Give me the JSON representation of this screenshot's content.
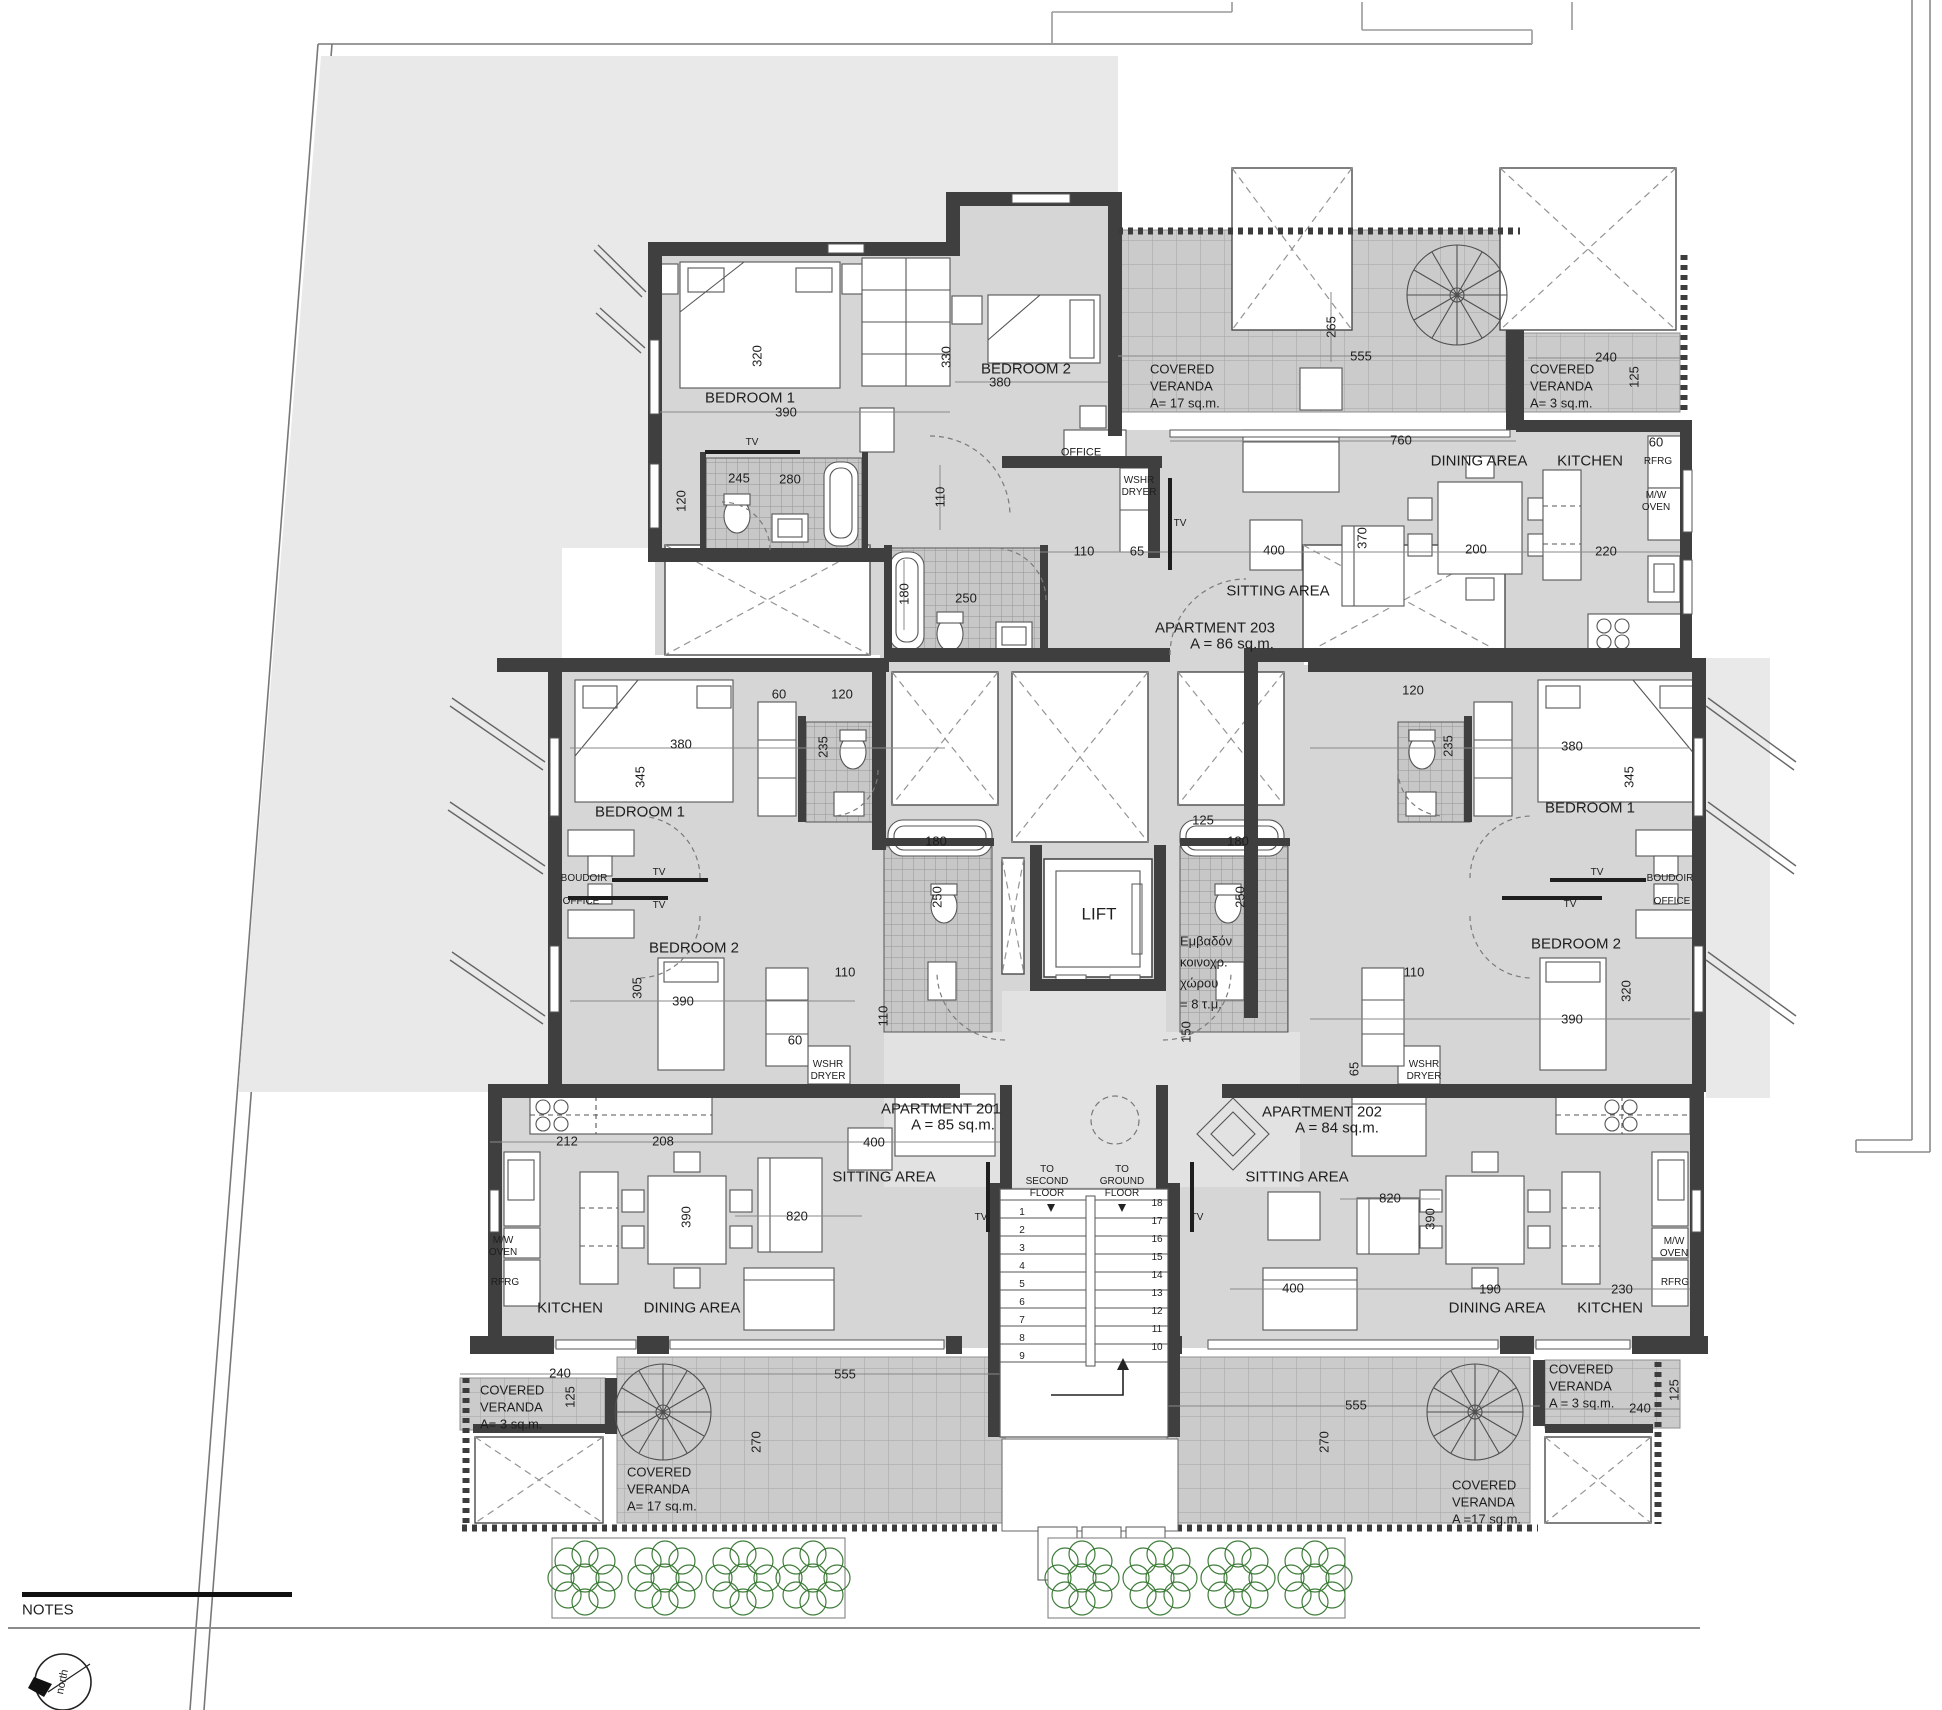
{
  "meta": {
    "drawing_type": "architectural floor plan",
    "notes_label": "NOTES",
    "north_label": "north"
  },
  "colors": {
    "wall": "#3f3f3f",
    "room_fill": "#d6d6d6",
    "deck_fill": "#e9e9e9",
    "veranda_fill": "#cbcbcb",
    "tree_green": "#3f7d3a",
    "line": "#555555"
  },
  "apartments": [
    {
      "name": "APARTMENT 201",
      "area": "A = 85 sq.m.",
      "rooms": [
        "BEDROOM 1",
        "BEDROOM 2",
        "SITTING AREA",
        "DINING AREA",
        "KITCHEN"
      ]
    },
    {
      "name": "APARTMENT 202",
      "area": "A = 84 sq.m.",
      "rooms": [
        "BEDROOM 1",
        "BEDROOM 2",
        "SITTING AREA",
        "DINING AREA",
        "KITCHEN"
      ]
    },
    {
      "name": "APARTMENT 203",
      "area": "A = 86 sq.m.",
      "rooms": [
        "BEDROOM 1",
        "BEDROOM 2",
        "SITTING AREA",
        "DINING AREA",
        "KITCHEN"
      ]
    }
  ],
  "common_area_note": [
    "Εμβαδόν",
    "κοινοχρ.",
    "χώρου",
    "= 8 τ.μ."
  ],
  "stairs": {
    "left_numbers": [
      1,
      2,
      3,
      4,
      5,
      6,
      7,
      8,
      9
    ],
    "right_numbers": [
      18,
      17,
      16,
      15,
      14,
      13,
      12,
      11,
      10
    ],
    "left_x": 1022,
    "left_y0": 1213,
    "right_x": 1157,
    "right_y0": 1204,
    "step": 18
  },
  "landscape": {
    "tree_rows": [
      {
        "y": 1578,
        "xs": [
          585,
          665,
          743,
          813
        ]
      },
      {
        "y": 1578,
        "xs": [
          1082,
          1160,
          1238,
          1315
        ]
      }
    ]
  },
  "labels": [
    {
      "t": "BEDROOM 1",
      "x": 750,
      "y": 398,
      "s": 15
    },
    {
      "t": "390",
      "x": 786,
      "y": 412
    },
    {
      "t": "320",
      "x": 757,
      "y": 356,
      "r": -90
    },
    {
      "t": "BEDROOM 2",
      "x": 1026,
      "y": 369,
      "s": 15
    },
    {
      "t": "380",
      "x": 1000,
      "y": 382
    },
    {
      "t": "330",
      "x": 946,
      "y": 357,
      "r": -90
    },
    {
      "t": "OFFICE",
      "x": 1081,
      "y": 453,
      "s": 11
    },
    {
      "t": "TV",
      "x": 752,
      "y": 443,
      "s": 10
    },
    {
      "t": "245",
      "x": 739,
      "y": 478
    },
    {
      "t": "120",
      "x": 681,
      "y": 501,
      "r": -90
    },
    {
      "t": "280",
      "x": 790,
      "y": 479
    },
    {
      "t": "110",
      "x": 940,
      "y": 497,
      "r": -90
    },
    {
      "t": "COVERED",
      "x": 1150,
      "y": 369,
      "a": "l"
    },
    {
      "t": "VERANDA",
      "x": 1150,
      "y": 386,
      "a": "l"
    },
    {
      "t": "A= 17 sq.m.",
      "x": 1150,
      "y": 403,
      "a": "l"
    },
    {
      "t": "265",
      "x": 1331,
      "y": 327,
      "r": -90
    },
    {
      "t": "555",
      "x": 1361,
      "y": 356
    },
    {
      "t": "COVERED",
      "x": 1530,
      "y": 369,
      "a": "l"
    },
    {
      "t": "VERANDA",
      "x": 1530,
      "y": 386,
      "a": "l"
    },
    {
      "t": "A= 3 sq.m.",
      "x": 1530,
      "y": 403,
      "a": "l"
    },
    {
      "t": "240",
      "x": 1606,
      "y": 357
    },
    {
      "t": "125",
      "x": 1634,
      "y": 377,
      "r": -90
    },
    {
      "t": "760",
      "x": 1401,
      "y": 440
    },
    {
      "t": "DINING AREA",
      "x": 1479,
      "y": 461,
      "s": 15
    },
    {
      "t": "200",
      "x": 1476,
      "y": 549
    },
    {
      "t": "KITCHEN",
      "x": 1590,
      "y": 461,
      "s": 15
    },
    {
      "t": "60",
      "x": 1656,
      "y": 442
    },
    {
      "t": "RFRG",
      "x": 1658,
      "y": 462,
      "s": 10
    },
    {
      "t": "M/W",
      "x": 1656,
      "y": 496,
      "s": 10
    },
    {
      "t": "OVEN",
      "x": 1656,
      "y": 508,
      "s": 10
    },
    {
      "t": "220",
      "x": 1606,
      "y": 551
    },
    {
      "t": "SITTING AREA",
      "x": 1278,
      "y": 591,
      "s": 15
    },
    {
      "t": "400",
      "x": 1274,
      "y": 550
    },
    {
      "t": "370",
      "x": 1362,
      "y": 538,
      "r": -90
    },
    {
      "t": "APARTMENT 203",
      "x": 1215,
      "y": 628,
      "s": 15
    },
    {
      "t": "A = 86 sq.m.",
      "x": 1232,
      "y": 644,
      "s": 15
    },
    {
      "t": "WSHR",
      "x": 1139,
      "y": 481,
      "s": 10
    },
    {
      "t": "DRYER",
      "x": 1139,
      "y": 493,
      "s": 10
    },
    {
      "t": "110",
      "x": 1084,
      "y": 551
    },
    {
      "t": "65",
      "x": 1137,
      "y": 551
    },
    {
      "t": "TV",
      "x": 1180,
      "y": 524,
      "s": 10
    },
    {
      "t": "180",
      "x": 904,
      "y": 594,
      "r": -90
    },
    {
      "t": "250",
      "x": 966,
      "y": 598
    },
    {
      "t": "LIFT",
      "x": 1099,
      "y": 914,
      "s": 17
    },
    {
      "t": "Εμβαδόν",
      "x": 1180,
      "y": 941,
      "a": "l"
    },
    {
      "t": "κοινοχρ.",
      "x": 1180,
      "y": 962,
      "a": "l"
    },
    {
      "t": "χώρου",
      "x": 1180,
      "y": 983,
      "a": "l"
    },
    {
      "t": "= 8 τ.μ.",
      "x": 1180,
      "y": 1004,
      "a": "l"
    },
    {
      "t": "125",
      "x": 1203,
      "y": 820
    },
    {
      "t": "150",
      "x": 1186,
      "y": 1032,
      "r": -90
    },
    {
      "t": "180",
      "x": 936,
      "y": 841
    },
    {
      "t": "250",
      "x": 937,
      "y": 897,
      "r": -90
    },
    {
      "t": "180",
      "x": 1238,
      "y": 841
    },
    {
      "t": "250",
      "x": 1240,
      "y": 897,
      "r": -90
    },
    {
      "t": "BEDROOM 1",
      "x": 640,
      "y": 812,
      "s": 15
    },
    {
      "t": "380",
      "x": 681,
      "y": 744
    },
    {
      "t": "345",
      "x": 640,
      "y": 777,
      "r": -90
    },
    {
      "t": "60",
      "x": 779,
      "y": 694
    },
    {
      "t": "120",
      "x": 842,
      "y": 694
    },
    {
      "t": "235",
      "x": 823,
      "y": 747,
      "r": -90
    },
    {
      "t": "BOUDOIR",
      "x": 584,
      "y": 879,
      "s": 10
    },
    {
      "t": "OFFICE",
      "x": 581,
      "y": 902,
      "s": 10
    },
    {
      "t": "TV",
      "x": 659,
      "y": 873,
      "s": 10
    },
    {
      "t": "TV",
      "x": 659,
      "y": 906,
      "s": 10
    },
    {
      "t": "BEDROOM 2",
      "x": 694,
      "y": 948,
      "s": 15
    },
    {
      "t": "390",
      "x": 683,
      "y": 1001
    },
    {
      "t": "305",
      "x": 637,
      "y": 988,
      "r": -90
    },
    {
      "t": "60",
      "x": 795,
      "y": 1040
    },
    {
      "t": "110",
      "x": 845,
      "y": 972
    },
    {
      "t": "110",
      "x": 883,
      "y": 1016,
      "r": -90
    },
    {
      "t": "WSHR",
      "x": 828,
      "y": 1065,
      "s": 10
    },
    {
      "t": "DRYER",
      "x": 828,
      "y": 1077,
      "s": 10
    },
    {
      "t": "APARTMENT 201",
      "x": 941,
      "y": 1109,
      "s": 15
    },
    {
      "t": "A = 85 sq.m.",
      "x": 953,
      "y": 1125,
      "s": 15
    },
    {
      "t": "400",
      "x": 874,
      "y": 1142
    },
    {
      "t": "SITTING AREA",
      "x": 884,
      "y": 1177,
      "s": 15
    },
    {
      "t": "820",
      "x": 797,
      "y": 1216
    },
    {
      "t": "390",
      "x": 686,
      "y": 1217,
      "r": -90
    },
    {
      "t": "212",
      "x": 567,
      "y": 1141
    },
    {
      "t": "208",
      "x": 663,
      "y": 1141
    },
    {
      "t": "KITCHEN",
      "x": 570,
      "y": 1308,
      "s": 15
    },
    {
      "t": "DINING AREA",
      "x": 692,
      "y": 1308,
      "s": 15
    },
    {
      "t": "M/W",
      "x": 503,
      "y": 1241,
      "s": 10
    },
    {
      "t": "OVEN",
      "x": 503,
      "y": 1253,
      "s": 10
    },
    {
      "t": "RFRG",
      "x": 505,
      "y": 1283,
      "s": 10
    },
    {
      "t": "TV",
      "x": 981,
      "y": 1218,
      "s": 10
    },
    {
      "t": "BEDROOM 1",
      "x": 1590,
      "y": 808,
      "s": 15
    },
    {
      "t": "380",
      "x": 1572,
      "y": 746
    },
    {
      "t": "345",
      "x": 1629,
      "y": 777,
      "r": -90
    },
    {
      "t": "120",
      "x": 1413,
      "y": 690
    },
    {
      "t": "235",
      "x": 1448,
      "y": 746,
      "r": -90
    },
    {
      "t": "BOUDOIR",
      "x": 1670,
      "y": 879,
      "s": 10
    },
    {
      "t": "OFFICE",
      "x": 1672,
      "y": 902,
      "s": 10
    },
    {
      "t": "TV",
      "x": 1597,
      "y": 873,
      "s": 10
    },
    {
      "t": "TV",
      "x": 1570,
      "y": 905,
      "s": 10
    },
    {
      "t": "BEDROOM 2",
      "x": 1576,
      "y": 944,
      "s": 15
    },
    {
      "t": "390",
      "x": 1572,
      "y": 1019
    },
    {
      "t": "320",
      "x": 1626,
      "y": 991,
      "r": -90
    },
    {
      "t": "110",
      "x": 1414,
      "y": 972
    },
    {
      "t": "65",
      "x": 1354,
      "y": 1069,
      "r": -90
    },
    {
      "t": "WSHR",
      "x": 1424,
      "y": 1065,
      "s": 10
    },
    {
      "t": "DRYER",
      "x": 1424,
      "y": 1077,
      "s": 10
    },
    {
      "t": "APARTMENT 202",
      "x": 1322,
      "y": 1112,
      "s": 15
    },
    {
      "t": "A = 84 sq.m.",
      "x": 1337,
      "y": 1128,
      "s": 15
    },
    {
      "t": "SITTING AREA",
      "x": 1297,
      "y": 1177,
      "s": 15
    },
    {
      "t": "820",
      "x": 1390,
      "y": 1198
    },
    {
      "t": "390",
      "x": 1430,
      "y": 1219,
      "r": -90
    },
    {
      "t": "400",
      "x": 1293,
      "y": 1288
    },
    {
      "t": "190",
      "x": 1490,
      "y": 1289
    },
    {
      "t": "230",
      "x": 1622,
      "y": 1289
    },
    {
      "t": "DINING AREA",
      "x": 1497,
      "y": 1308,
      "s": 15
    },
    {
      "t": "KITCHEN",
      "x": 1610,
      "y": 1308,
      "s": 15
    },
    {
      "t": "M/W",
      "x": 1674,
      "y": 1242,
      "s": 10
    },
    {
      "t": "OVEN",
      "x": 1674,
      "y": 1254,
      "s": 10
    },
    {
      "t": "RFRG",
      "x": 1675,
      "y": 1283,
      "s": 10
    },
    {
      "t": "TV",
      "x": 1197,
      "y": 1218,
      "s": 10
    },
    {
      "t": "240",
      "x": 560,
      "y": 1373
    },
    {
      "t": "125",
      "x": 570,
      "y": 1397,
      "r": -90
    },
    {
      "t": "COVERED",
      "x": 480,
      "y": 1390,
      "a": "l"
    },
    {
      "t": "VERANDA",
      "x": 480,
      "y": 1407,
      "a": "l"
    },
    {
      "t": "A= 3 sq.m.",
      "x": 480,
      "y": 1424,
      "a": "l"
    },
    {
      "t": "555",
      "x": 845,
      "y": 1374
    },
    {
      "t": "270",
      "x": 756,
      "y": 1442,
      "r": -90
    },
    {
      "t": "COVERED",
      "x": 627,
      "y": 1472,
      "a": "l"
    },
    {
      "t": "VERANDA",
      "x": 627,
      "y": 1489,
      "a": "l"
    },
    {
      "t": "A= 17 sq.m.",
      "x": 627,
      "y": 1506,
      "a": "l"
    },
    {
      "t": "TO",
      "x": 1047,
      "y": 1170,
      "s": 10
    },
    {
      "t": "SECOND",
      "x": 1047,
      "y": 1182,
      "s": 10
    },
    {
      "t": "FLOOR",
      "x": 1047,
      "y": 1194,
      "s": 10
    },
    {
      "t": "TO",
      "x": 1122,
      "y": 1170,
      "s": 10
    },
    {
      "t": "GROUND",
      "x": 1122,
      "y": 1182,
      "s": 10
    },
    {
      "t": "FLOOR",
      "x": 1122,
      "y": 1194,
      "s": 10
    },
    {
      "t": "555",
      "x": 1356,
      "y": 1405
    },
    {
      "t": "270",
      "x": 1324,
      "y": 1442,
      "r": -90
    },
    {
      "t": "COVERED",
      "x": 1452,
      "y": 1485,
      "a": "l"
    },
    {
      "t": "VERANDA",
      "x": 1452,
      "y": 1502,
      "a": "l"
    },
    {
      "t": "A =17 sq.m.",
      "x": 1452,
      "y": 1519,
      "a": "l"
    },
    {
      "t": "COVERED",
      "x": 1549,
      "y": 1369,
      "a": "l"
    },
    {
      "t": "VERANDA",
      "x": 1549,
      "y": 1386,
      "a": "l"
    },
    {
      "t": "A = 3 sq.m.",
      "x": 1549,
      "y": 1403,
      "a": "l"
    },
    {
      "t": "240",
      "x": 1640,
      "y": 1408
    },
    {
      "t": "125",
      "x": 1674,
      "y": 1390,
      "r": -90
    },
    {
      "t": "NOTES",
      "x": 22,
      "y": 1610,
      "a": "l",
      "s": 15
    },
    {
      "t": "north",
      "x": 63,
      "y": 1682,
      "r": -78,
      "s": 11
    }
  ]
}
